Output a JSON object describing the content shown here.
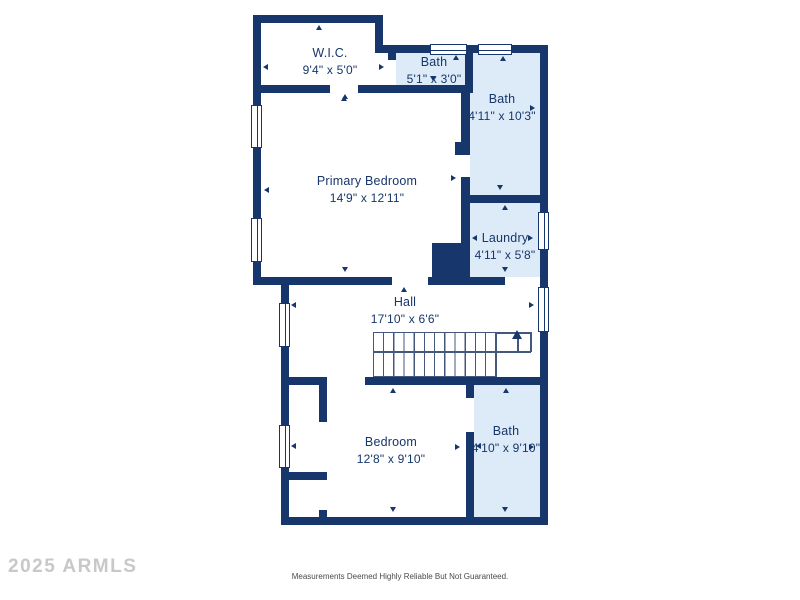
{
  "floorplan": {
    "rooms": [
      {
        "name": "W.I.C.",
        "dimensions": "9'4\" x 5'0\"",
        "highlighted": false
      },
      {
        "name": "Bath",
        "dimensions": "5'1\" x 3'0\"",
        "highlighted": true
      },
      {
        "name": "Bath",
        "dimensions": "4'11\" x 10'3\"",
        "highlighted": true
      },
      {
        "name": "Primary Bedroom",
        "dimensions": "14'9\" x 12'11\"",
        "highlighted": false
      },
      {
        "name": "Laundry",
        "dimensions": "4'11\" x 5'8\"",
        "highlighted": true
      },
      {
        "name": "Hall",
        "dimensions": "17'10\" x 6'6\"",
        "highlighted": false
      },
      {
        "name": "Bedroom",
        "dimensions": "12'8\" x 9'10\"",
        "highlighted": false
      },
      {
        "name": "Bath",
        "dimensions": "4'10\" x 9'10\"",
        "highlighted": true
      }
    ],
    "colors": {
      "wall": "#17366b",
      "room_highlight": "#dcebf7",
      "room_default": "#ffffff",
      "label_text": "#17366b",
      "stair_line": "#44587d"
    }
  },
  "watermark": {
    "text": "2025 ARMLS",
    "color": "#c8c8c8"
  },
  "disclaimer": {
    "text": "Measurements Deemed Highly Reliable But Not Guaranteed.",
    "color": "#4a4a4a"
  }
}
